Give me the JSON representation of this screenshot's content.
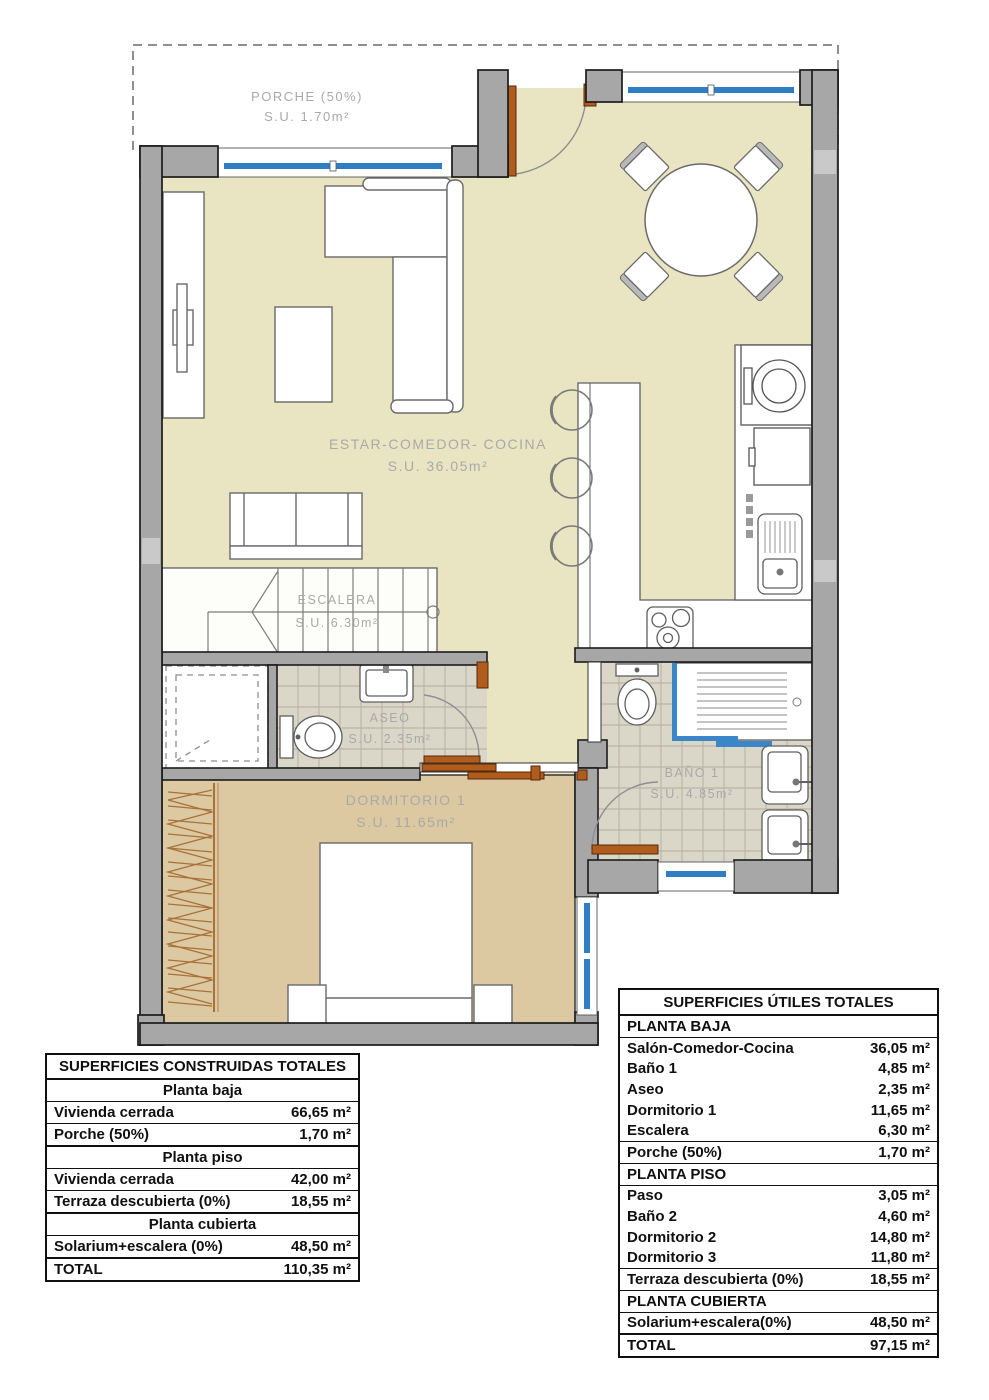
{
  "plan": {
    "rooms": [
      {
        "name": "PORCHE (50%)",
        "area": "S.U. 1.70m²"
      },
      {
        "name": "ESTAR-COMEDOR- COCINA",
        "area": "S.U. 36.05m²"
      },
      {
        "name": "ESCALERA",
        "area": "S.U. 6.30m²"
      },
      {
        "name": "ASEO",
        "area": "S.U. 2.35m²"
      },
      {
        "name": "DORMITORIO 1",
        "area": "S.U. 11.65m²"
      },
      {
        "name": "BAÑO 1",
        "area": "S.U. 4.85m²"
      }
    ],
    "colors": {
      "floor_main": "#e9e5c2",
      "floor_bedroom": "#dcc9a2",
      "floor_tile": "#dad6c8",
      "wall": "#a7a7a7",
      "window_blue": "#2f7dc2",
      "door_brown": "#b05c1d"
    }
  },
  "tables": {
    "built": {
      "title": "SUPERFICIES CONSTRUIDAS TOTALES",
      "rows": [
        {
          "type": "section",
          "label": "Planta baja"
        },
        {
          "type": "data",
          "label": "Vivienda cerrada",
          "value": "66,65 m²"
        },
        {
          "type": "data",
          "label": "Porche (50%)",
          "value": "1,70 m²"
        },
        {
          "type": "section",
          "label": "Planta piso"
        },
        {
          "type": "data",
          "label": "Vivienda cerrada",
          "value": "42,00 m²"
        },
        {
          "type": "data",
          "label": "Terraza descubierta (0%)",
          "value": "18,55 m²"
        },
        {
          "type": "section",
          "label": "Planta cubierta"
        },
        {
          "type": "data",
          "label": "Solarium+escalera (0%)",
          "value": "48,50 m²"
        },
        {
          "type": "data",
          "label": "TOTAL",
          "value": "110,35 m²"
        }
      ]
    },
    "useful": {
      "title": "SUPERFICIES ÚTILES TOTALES",
      "rows": [
        {
          "type": "section",
          "label": "PLANTA BAJA"
        },
        {
          "type": "data",
          "label": "Salón-Comedor-Cocina",
          "value": "36,05 m²"
        },
        {
          "type": "data",
          "label": "Baño 1",
          "value": "4,85 m²"
        },
        {
          "type": "data",
          "label": "Aseo",
          "value": "2,35 m²"
        },
        {
          "type": "data",
          "label": "Dormitorio 1",
          "value": "11,65 m²"
        },
        {
          "type": "data",
          "label": "Escalera",
          "value": "6,30 m²"
        },
        {
          "type": "data",
          "label": "Porche (50%)",
          "value": "1,70 m²"
        },
        {
          "type": "section",
          "label": "PLANTA PISO"
        },
        {
          "type": "data",
          "label": "Paso",
          "value": "3,05 m²"
        },
        {
          "type": "data",
          "label": "Baño 2",
          "value": "4,60 m²"
        },
        {
          "type": "data",
          "label": "Dormitorio 2",
          "value": "14,80 m²"
        },
        {
          "type": "data",
          "label": "Dormitorio 3",
          "value": "11,80 m²"
        },
        {
          "type": "data",
          "label": "Terraza descubierta (0%)",
          "value": "18,55 m²"
        },
        {
          "type": "section",
          "label": "PLANTA CUBIERTA"
        },
        {
          "type": "data",
          "label": "Solarium+escalera(0%)",
          "value": "48,50 m²"
        },
        {
          "type": "data",
          "label": "TOTAL",
          "value": "97,15 m²"
        }
      ]
    }
  }
}
